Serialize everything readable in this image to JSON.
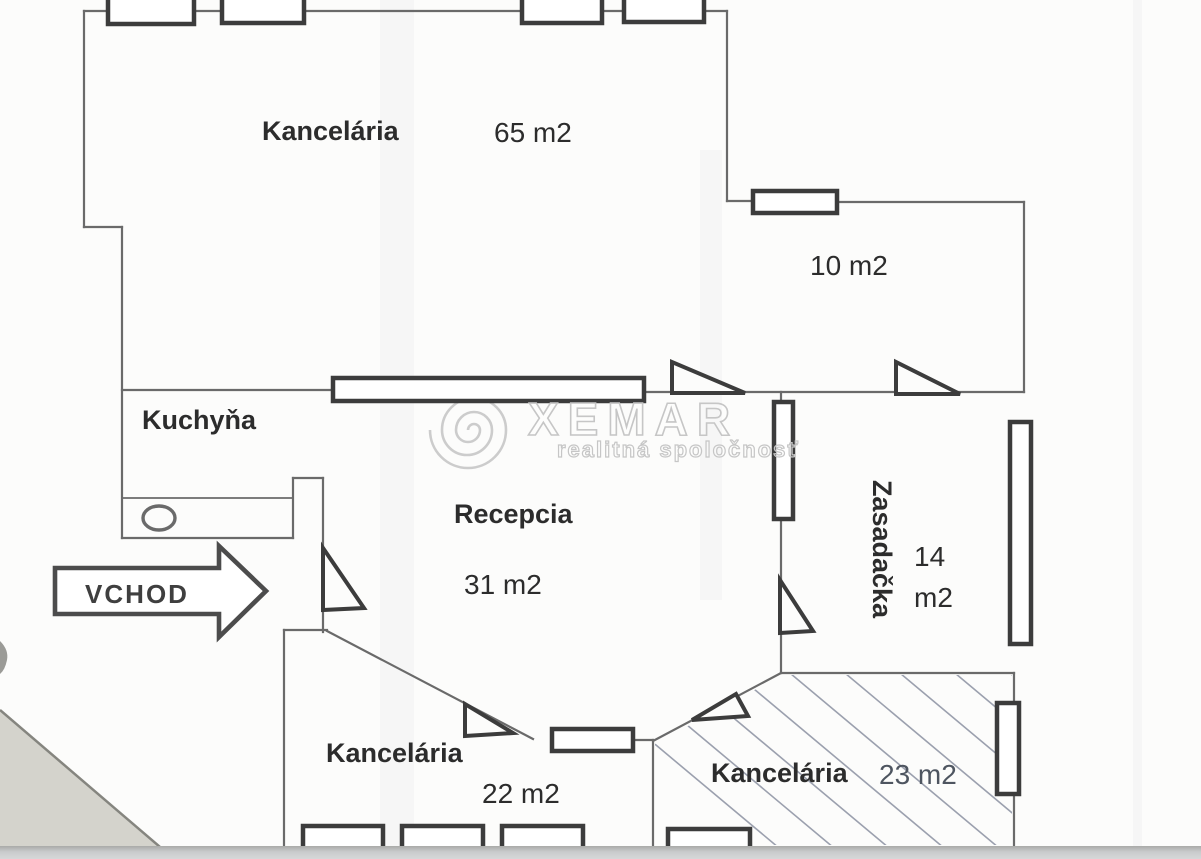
{
  "plan": {
    "rooms": {
      "office_large": {
        "name": "Kancelária",
        "area": "65 m2"
      },
      "small_room": {
        "area": "10 m2"
      },
      "kitchen": {
        "name": "Kuchyňa"
      },
      "reception": {
        "name": "Recepcia",
        "area": "31 m2"
      },
      "meeting_room": {
        "name": "Zasadačka",
        "area": "14 m2"
      },
      "office_sw": {
        "name": "Kancelária",
        "area": "22 m2"
      },
      "office_se": {
        "name": "Kancelária",
        "area": "23 m2"
      }
    },
    "entrance": {
      "label": "VCHOD"
    }
  },
  "watermark": {
    "brand": "XEMAR",
    "tagline": "realitná spoločnosť",
    "logo": "spiral-icon"
  },
  "colors": {
    "wall": "#6a6a6a",
    "fixture": "#3c3c3c",
    "text": "#2c2c2c",
    "hatch": "#7b8294",
    "watermark": "#c6c6c6",
    "paper": "#fcfcfb",
    "scan_shadow": "#c5c7c8"
  }
}
